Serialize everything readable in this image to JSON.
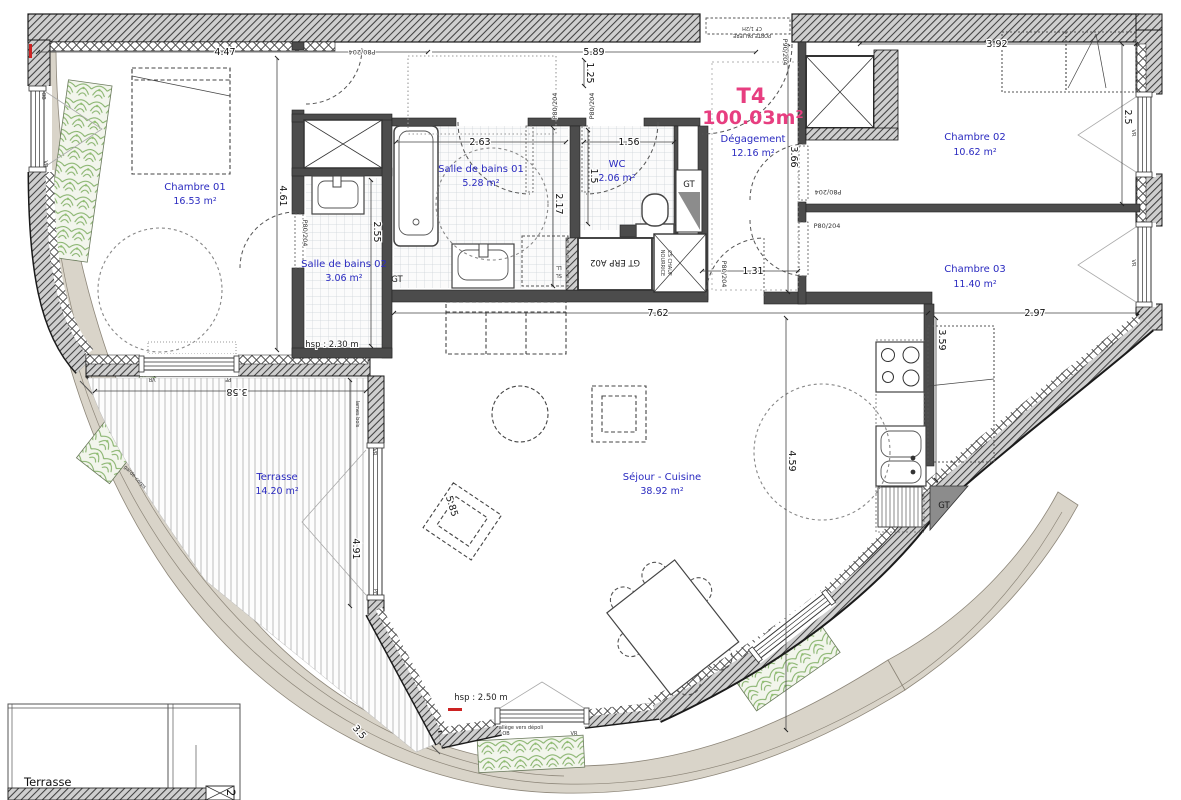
{
  "title": {
    "unit": "T4",
    "area": "100.03m²"
  },
  "rooms": {
    "chambre01": {
      "name": "Chambre 01",
      "area": "16.53 m²"
    },
    "chambre02": {
      "name": "Chambre 02",
      "area": "10.62 m²"
    },
    "chambre03": {
      "name": "Chambre 03",
      "area": "11.40 m²"
    },
    "sdb01": {
      "name": "Salle de bains 01",
      "area": "5.28 m²"
    },
    "sdb02": {
      "name": "Salle de bains 02",
      "area": "3.06 m²"
    },
    "wc": {
      "name": "WC",
      "area": "2.06 m²"
    },
    "degagement": {
      "name": "Dégagement",
      "area": "12.16 m²"
    },
    "sejour": {
      "name": "Séjour - Cuisine",
      "area": "38.92 m²"
    },
    "terrasse": {
      "name": "Terrasse",
      "area": "14.20 m²"
    },
    "adjacent": {
      "name": "Terrasse",
      "number": "2"
    }
  },
  "ceiling": {
    "sdb02": "hsp : 2.30 m",
    "sejour": "hsp : 2.50 m"
  },
  "dims": {
    "w_ch01": "4.47",
    "w_top": "5.89",
    "w_ch02": "3.92",
    "w_sdb01": "2.63",
    "w_wc": "1.56",
    "h_entry": "1.25",
    "h_ch01": "4.61",
    "h_sdb02": "2.55",
    "h_sdb01": "2.17",
    "h_wc": "1.5",
    "h_deg": "3.66",
    "h_ch02": "2.5",
    "w_deg": "1.31",
    "w_sejour": "7.62",
    "w_ch03": "2.97",
    "h_kitchen": "3.59",
    "h_sejour": "4.59",
    "h_terr": "4.91",
    "w_terr": "3.58",
    "diag_chair": "5.85",
    "diag_terr": "3.5"
  },
  "doors": {
    "std": "P80/204",
    "entry": "P90/204",
    "paliere1": "PORTE PALIERE",
    "paliere2": "CF 1/2H"
  },
  "annot": {
    "gt": "GT",
    "gt_erp": "GT ERP A02",
    "nour1": "NOURRICE",
    "nour2": "CS CHAUF",
    "ll": "LL",
    "sl": "SL",
    "ob": "OB",
    "vr": "VR",
    "pf": "PF",
    "lames": "lames bois",
    "garde": "garde-corps",
    "allege": "allège vers dépoli"
  },
  "colors": {
    "title_pink": "#e73e80",
    "room_blue": "#2a2ac0",
    "wall_dark": "#4c4c4c",
    "facade_beige": "#d9d4c9",
    "plant_green": "#7fae63",
    "accent_red": "#cc2222"
  }
}
